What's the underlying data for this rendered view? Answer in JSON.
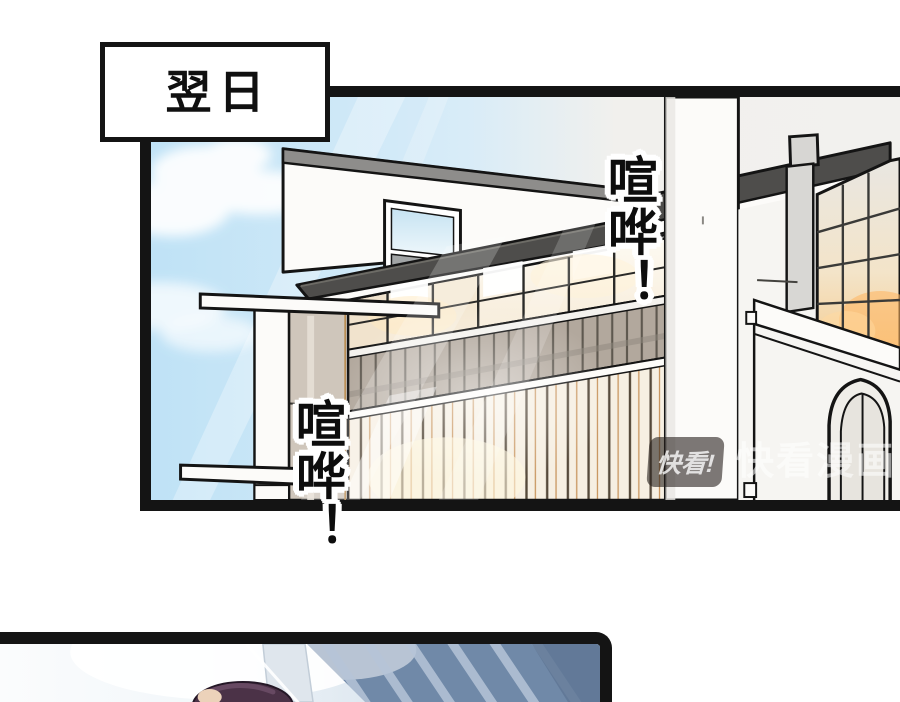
{
  "caption_box": {
    "text": "翌日"
  },
  "sfx": {
    "top_right": "喧哗！",
    "bottom_left": "喧哗！"
  },
  "watermark": {
    "logo_text": "快看!",
    "brand_text": "快看漫画"
  },
  "scene": {
    "main_panel": "daytime exterior of a modern white house with dark sloped roofs, glowing grid windows, balcony slats, white chimney column and arched window under a blue sky with clouds and light beams",
    "bottom_panel": "low-angle view of a blue glass skyscraper with diagonal light bands, bright sky glow, top of a character's head entering from bottom edge"
  },
  "colors": {
    "ink": "#141414",
    "sky_blue": "#bfe2f6",
    "sky_haze": "#f1f0ed",
    "roof_dark": "#4e4d4b",
    "wall_white": "#fcfbf9",
    "window_warm": "#f6e9d4",
    "window_glow": "#fff6e6",
    "wood_orange": "#c08445",
    "balcony_taupe": "#b2a89d",
    "scraper_blue": "#7089a8",
    "scraper_stripe": "#b6c5d8",
    "hair_dark": "#4b3247"
  }
}
